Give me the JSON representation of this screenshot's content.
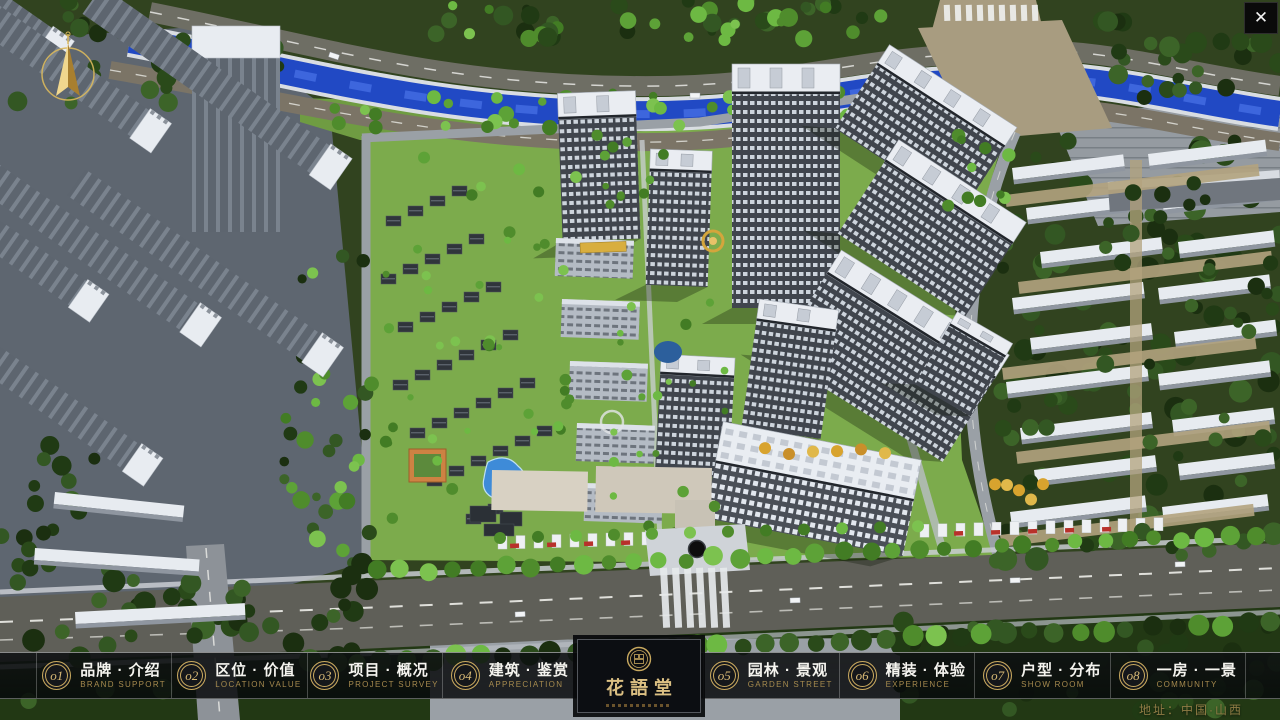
{
  "colors": {
    "accent_gold": "#c9a95f",
    "nav_text": "#f5f4ef",
    "nav_subtext": "#a68a4e"
  },
  "close": {
    "label": "✕"
  },
  "logo": {
    "title": "花語堂"
  },
  "footer": {
    "address": "地址：中国·山西"
  },
  "nav": {
    "items": [
      {
        "num": "o1",
        "zh": "品牌 · 介绍",
        "en": "BRAND SUPPORT"
      },
      {
        "num": "o2",
        "zh": "区位 · 价值",
        "en": "LOCATION VALUE"
      },
      {
        "num": "o3",
        "zh": "项目 · 概况",
        "en": "PROJECT SURVEY"
      },
      {
        "num": "o4",
        "zh": "建筑 · 鉴赏",
        "en": "APPRECIATION"
      },
      {
        "num": "o5",
        "zh": "园林 · 景观",
        "en": "GARDEN STREET"
      },
      {
        "num": "o6",
        "zh": "精装 · 体验",
        "en": "EXPERIENCE"
      },
      {
        "num": "o7",
        "zh": "户型 · 分布",
        "en": "SHOW ROOM"
      },
      {
        "num": "o8",
        "zh": "一房 · 一景",
        "en": "COMMUNITY"
      }
    ]
  }
}
